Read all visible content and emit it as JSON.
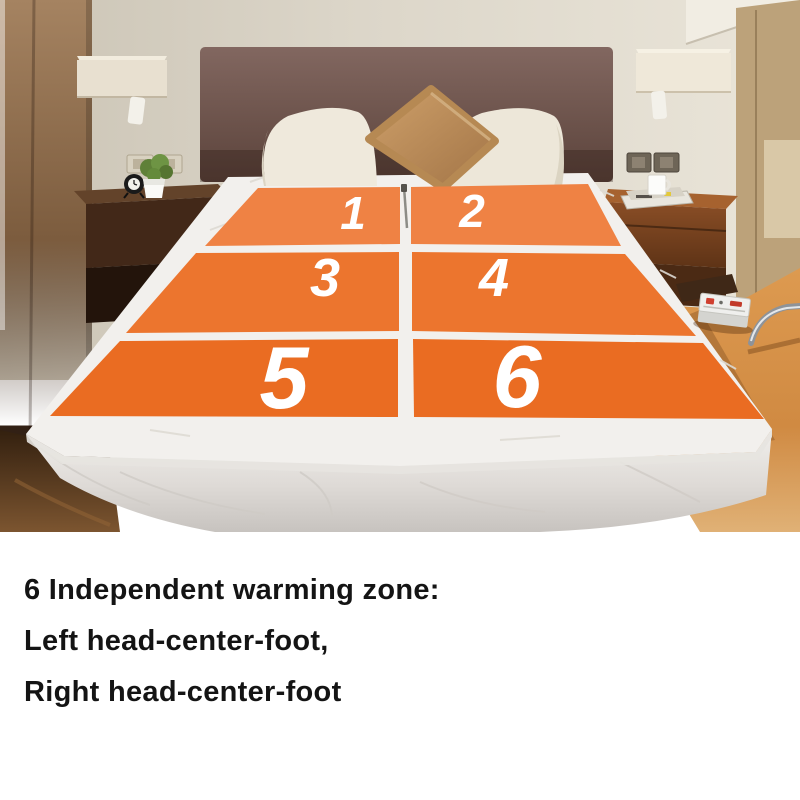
{
  "caption": {
    "lines": [
      "6 Independent warming zone:",
      "Left head-center-foot,",
      "Right head-center-foot"
    ]
  },
  "zones": {
    "labels": [
      "1",
      "2",
      "3",
      "4",
      "5",
      "6"
    ]
  },
  "colors": {
    "zone_row1": "#EF8244",
    "zone_row2": "#EC752E",
    "zone_row3": "#EA6C22",
    "zone_number": "#FFFFFF",
    "caption_text": "#141414",
    "page_background": "#FFFFFF"
  }
}
